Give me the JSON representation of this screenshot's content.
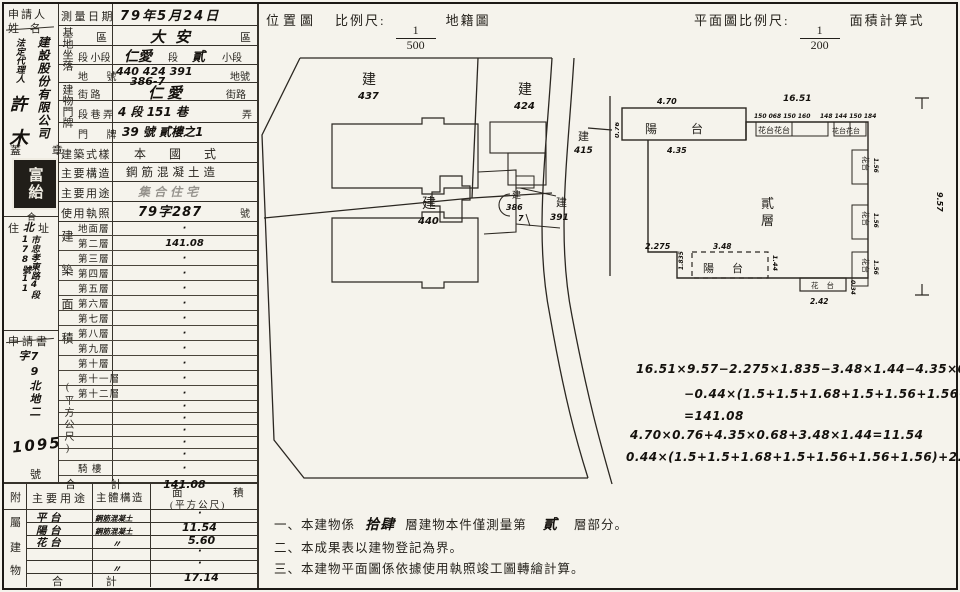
{
  "applicant": {
    "label_line1": "申請人",
    "label_line2": "姓 名",
    "company_vertical": "建設股份有限公司",
    "agent_title_vertical": "法定代理人",
    "agent_char1": "許",
    "agent_char2": "木",
    "seal_label": "蓋  章",
    "seal_chars": "富紿",
    "seal_mark": "合",
    "addr_label_left": "住",
    "addr_hand_mid": "北",
    "addr_label_right": "址",
    "addr_vertical": "市忠孝東路4段178號11",
    "app_label": "申請書",
    "app_no_vertical": "79北地二字",
    "app_no_big": "1095",
    "app_no_suffix": "號"
  },
  "survey_date": {
    "label": "測量日期",
    "value": "79年5月24日"
  },
  "site": {
    "group_vertical": "基地坐落",
    "district": {
      "label": "區",
      "value": "大安",
      "suffix": "區"
    },
    "section": {
      "label": "段 小段",
      "v1": "仁愛",
      "m1": "段",
      "v2": "貳",
      "suffix": "小段"
    },
    "lot": {
      "label": "地 號",
      "value": "440 424 391",
      "value2": "386-7",
      "suffix": "地號"
    }
  },
  "door": {
    "group_vertical": "建物門牌",
    "street": {
      "label": "街 路",
      "value": "仁愛",
      "suffix": "街路"
    },
    "lane": {
      "label": "段 巷 弄",
      "value": "4 段 151 巷",
      "suffix": "弄"
    },
    "number": {
      "label": "門 牌",
      "value": "39 號 貳樓之1"
    }
  },
  "building": {
    "style": {
      "label": "建築式樣",
      "value": "本 國 式"
    },
    "structure": {
      "label": "主要構造",
      "value": "鋼筋混凝土造"
    },
    "use": {
      "label": "主要用途",
      "value": "集合住宅"
    },
    "permit": {
      "label": "使用執照",
      "value": "79字287",
      "suffix": "號"
    }
  },
  "floor_area": {
    "group_vertical": "建築面積",
    "unit_vertical": "(平方公尺)",
    "rows": [
      {
        "label": "地面層",
        "value": "·"
      },
      {
        "label": "第二層",
        "value": "141.08"
      },
      {
        "label": "第三層",
        "value": "·"
      },
      {
        "label": "第四層",
        "value": "·"
      },
      {
        "label": "第五層",
        "value": "·"
      },
      {
        "label": "第六層",
        "value": "·"
      },
      {
        "label": "第七層",
        "value": "·"
      },
      {
        "label": "第八層",
        "value": "·"
      },
      {
        "label": "第九層",
        "value": "·"
      },
      {
        "label": "第十層",
        "value": "·"
      },
      {
        "label": "第十一層",
        "value": "·"
      },
      {
        "label": "第十二層",
        "value": "·"
      },
      {
        "label": "",
        "value": "·"
      },
      {
        "label": "",
        "value": "·"
      },
      {
        "label": "",
        "value": "·"
      },
      {
        "label": "",
        "value": "·"
      },
      {
        "label": "",
        "value": "·"
      },
      {
        "label": "騎 樓",
        "value": "·"
      }
    ],
    "total": {
      "label": "合 計",
      "value": "141.08"
    }
  },
  "attached": {
    "corner_label": "附",
    "group_c1": "屬",
    "group_c2": "建",
    "group_c3": "物",
    "headers": {
      "use": "主要用途",
      "structure": "主體構造",
      "area_top": "面 積",
      "area_bottom": "(平方公尺)"
    },
    "rows": [
      {
        "use": "平 台",
        "structure": "鋼筋混凝土",
        "area": "·"
      },
      {
        "use": "陽 台",
        "structure": "鋼筋混凝土",
        "area": "11.54"
      },
      {
        "use": "花 台",
        "structure": "〃",
        "area": "5.60"
      },
      {
        "use": "",
        "structure": "",
        "area": "·"
      },
      {
        "use": "",
        "structure": "〃",
        "area": "·"
      }
    ],
    "total": {
      "label": "合 計",
      "value": "17.14"
    }
  },
  "location_map": {
    "title": "位置圖",
    "scale_label": "比例尺:",
    "scale_num": "1",
    "scale_den": "500",
    "suffix": "地籍圖",
    "parcels": {
      "p437_t": "建",
      "p437_n": "437",
      "p424_t": "建",
      "p424_n": "424",
      "p415_t": "建",
      "p415_n": "415",
      "p440_t": "建",
      "p440_n": "440",
      "p386_t": "建",
      "p386_n": "386",
      "p386_n2": "7",
      "p391_t": "建",
      "p391_n": "391"
    }
  },
  "floor_plan": {
    "title": "平面圖比例尺:",
    "scale_num": "1",
    "scale_den": "200",
    "suffix": "面積計算式",
    "floor_char1": "貳",
    "floor_char2": "層",
    "balcony_top_label": "陽台",
    "balcony_bottom_label": "陽台",
    "flower_top_left": "花台花台",
    "flower_top_right": "花台花台",
    "flower_right_label": "花台",
    "flower_bottom_label": "花台",
    "dims": {
      "width_total": "16.51",
      "top_left_small": "150 068 150 160",
      "top_right_small": "148 144 150 184",
      "balcony_width": "4.70",
      "balcony_inner": "4.35",
      "balcony_height": "0.76",
      "height_total": "9.57",
      "notch_width": "2.275",
      "notch_height": "1.835",
      "bottom_balcony_width": "3.48",
      "bottom_balcony_height": "1.44",
      "bottom_flower_width": "2.42",
      "bottom_flower_height": "0.34",
      "right_seg": "1.56"
    }
  },
  "calculations": {
    "line1": "16.51×9.57−2.275×1.835−3.48×1.44−4.35×0.68",
    "line2": "−0.44×(1.5+1.5+1.68+1.5+1.56+1.56+1.56)",
    "line3": "=141.08",
    "line4": "4.70×0.76+4.35×0.68+3.48×1.44=11.54",
    "line5": "0.44×(1.5+1.5+1.68+1.5+1.56+1.56+1.56)+2.42×0.34=5.60"
  },
  "notes": {
    "n1_pre": "一、本建物係",
    "n1_hand1": "拾肆",
    "n1_mid": "層建物本件僅測量第",
    "n1_hand2": "貳",
    "n1_post": "層部分。",
    "n2": "二、本成果表以建物登記為界。",
    "n3": "三、本建物平面圖係依據使用執照竣工圖轉繪計算。"
  }
}
